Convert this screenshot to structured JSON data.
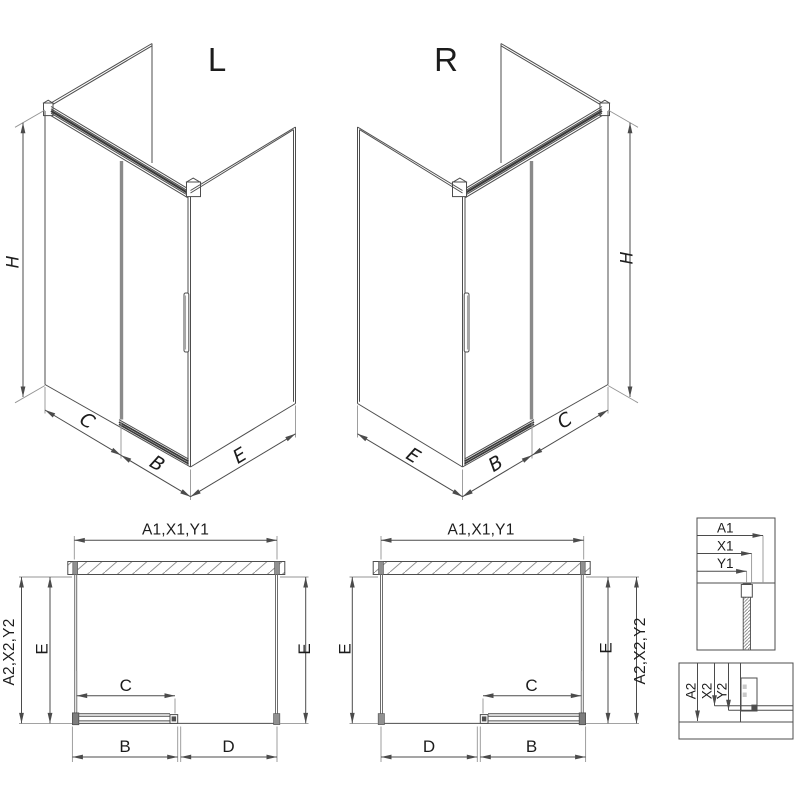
{
  "drawing": {
    "iso_left": {
      "title": "L",
      "height": "H",
      "panel_width": "C",
      "door_width": "B",
      "side_depth": "E"
    },
    "iso_right": {
      "title": "R",
      "height": "H",
      "panel_width": "C",
      "door_width": "B",
      "side_depth": "E"
    },
    "plan_left": {
      "overall_width": "A1,X1,Y1",
      "overall_depth": "A2,X2,Y2",
      "side_left": "E",
      "side_right": "E",
      "clear_width": "C",
      "door_width": "B",
      "fixed_width": "D"
    },
    "plan_right": {
      "overall_width": "A1,X1,Y1",
      "overall_depth": "A2,X2,Y2",
      "side_left": "E",
      "side_right": "E",
      "clear_width": "C",
      "door_width": "B",
      "fixed_width": "D"
    },
    "detail_width_labels": [
      "A1",
      "X1",
      "Y1"
    ],
    "detail_depth_labels": [
      "A2",
      "X2",
      "Y2"
    ],
    "colors": {
      "line": "#4d4d4d",
      "line_dark": "#3a3a3a",
      "line_light": "#949494",
      "fill_gray": "#909090",
      "text": "#1c1c1c",
      "background": "#ffffff"
    }
  }
}
